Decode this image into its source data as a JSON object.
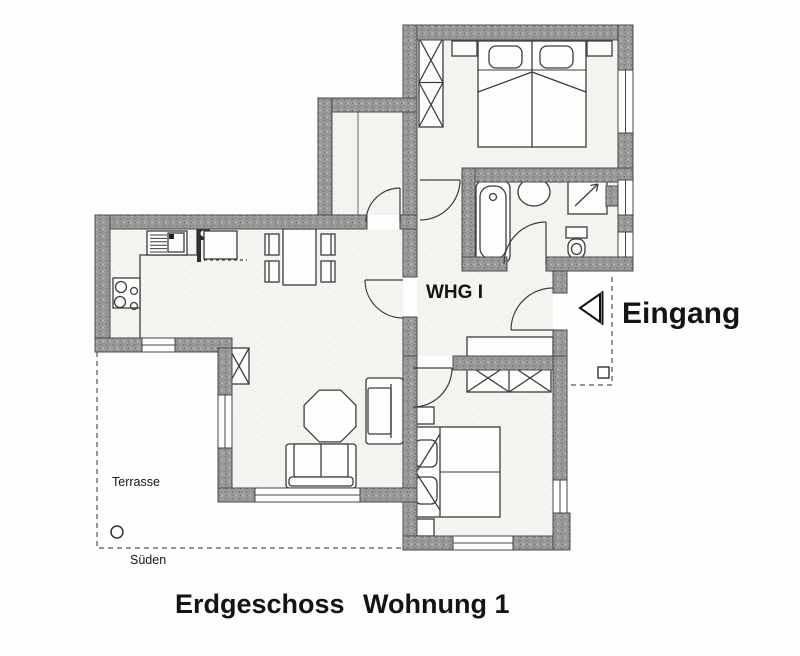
{
  "labels": {
    "unit": "WHG I",
    "entrance": "Eingang",
    "terrace": "Terrasse",
    "south": "Süden",
    "title_floor": "Erdgeschoss",
    "title_apartment": "Wohnung 1"
  },
  "colors": {
    "wall_fill": "#9a9a9a",
    "wall_edge": "#4a4a4a",
    "line": "#3d3d3d",
    "room_fill": "#f4f4f1",
    "page_background": "#fefefe",
    "text": "#141414"
  }
}
